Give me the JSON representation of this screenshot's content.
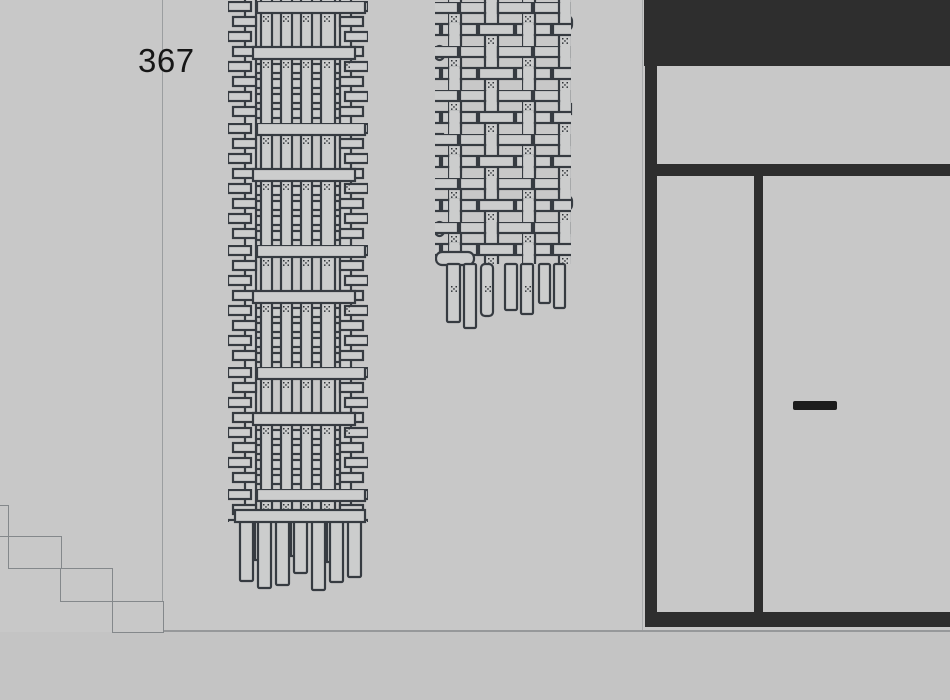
{
  "scene": {
    "type_label": "storefront-elevation",
    "wall": {
      "number_label": "367"
    },
    "objects": {
      "left_hanging": "woven-wall-hanging-large",
      "right_hanging": "woven-wall-hanging-small",
      "stairs": "descending-steps-outline",
      "storefront": "dark-frame-glazing",
      "door_handle": "horizontal-pull-handle"
    },
    "colors": {
      "background": "#c8c8c8",
      "frame_dark": "#2e2e2e",
      "outline_gray": "#84888b",
      "ground_line": "#96989a",
      "weave_stroke": "#363b41",
      "weave_fill": "#cccdcd",
      "handle": "#1c1c1c",
      "label_text": "#161616"
    }
  }
}
